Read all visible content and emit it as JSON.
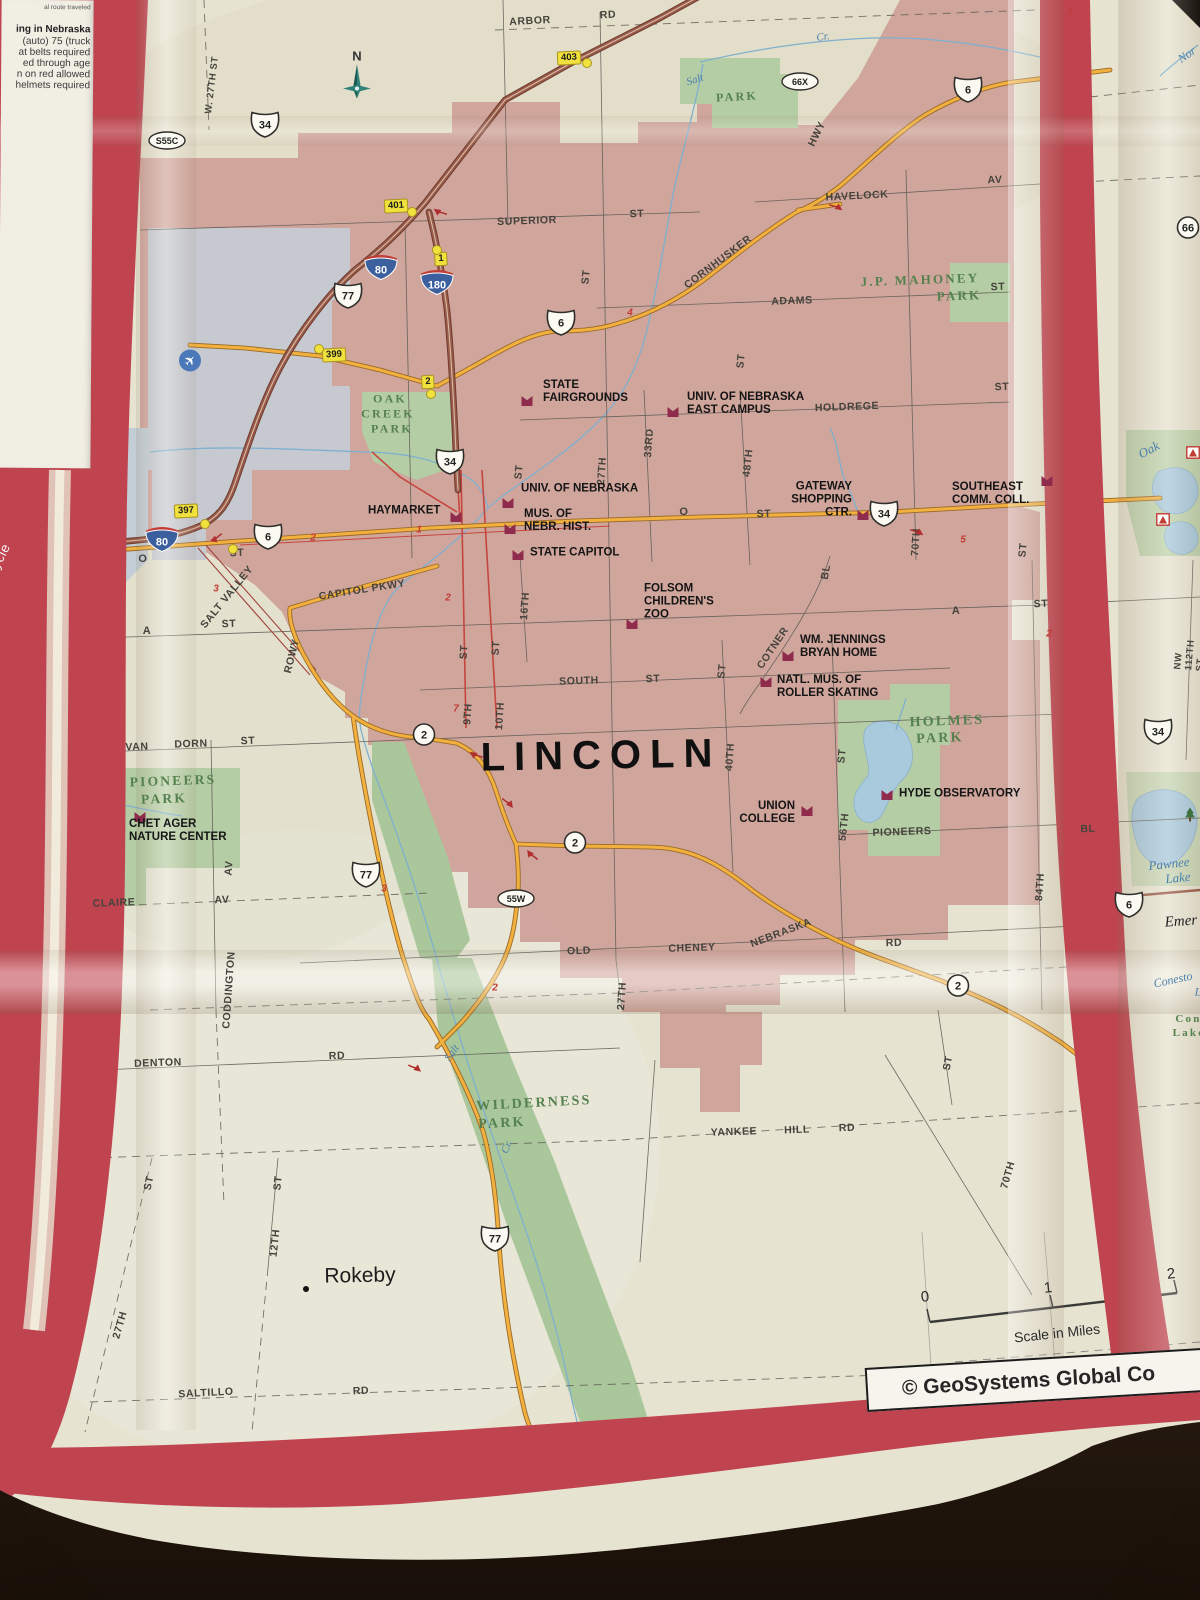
{
  "colors": {
    "border_red": "#bf4450",
    "urban_pink": "#cfa29a",
    "park_green": "#b5cda4",
    "water_blue": "#a9c9dc",
    "road_orange": "#f2b13f",
    "interstate_brown": "#9a5a48",
    "thin_red_road": "#c5463e",
    "paper": "#e7e3d1"
  },
  "panel": {
    "recycle": "♻ Please Recycle",
    "lines": [
      {
        "t": "al route traveled",
        "y": 4,
        "cls": "tiny"
      },
      {
        "t": "ing in Nebraska",
        "y": 24,
        "cls": "b"
      },
      {
        "t": "(auto) 75 (truck",
        "y": 36,
        "cls": ""
      },
      {
        "t": "at belts required",
        "y": 47,
        "cls": ""
      },
      {
        "t": "ed through age",
        "y": 58,
        "cls": ""
      },
      {
        "t": "n on red allowed",
        "y": 69,
        "cls": ""
      },
      {
        "t": "helmets required",
        "y": 80,
        "cls": ""
      }
    ]
  },
  "map": {
    "city": "LINCOLN",
    "city_xy": [
      601,
      756
    ],
    "compass": "N",
    "compass_xy": [
      357,
      82
    ],
    "credit": "© GeoSystems Global Co",
    "streets": [
      [
        "ARBOR",
        530,
        21,
        -3
      ],
      [
        "RD",
        608,
        15,
        -3
      ],
      [
        "W. 27TH ST",
        212,
        85,
        -83,
        9.5
      ],
      [
        "SUPERIOR",
        527,
        221,
        -2
      ],
      [
        "ST",
        637,
        214,
        -2
      ],
      [
        "HAVELOCK",
        857,
        196,
        -3
      ],
      [
        "AV",
        995,
        180,
        -2
      ],
      [
        "CORNHUSKER",
        718,
        262,
        -37
      ],
      [
        "HWY",
        817,
        134,
        -64
      ],
      [
        "ADAMS",
        792,
        301,
        -2
      ],
      [
        "ST",
        586,
        277,
        -84
      ],
      [
        "ST",
        998,
        287,
        -2
      ],
      [
        "HOLDREGE",
        847,
        407,
        -2
      ],
      [
        "ST",
        1002,
        387,
        -2
      ],
      [
        "ST",
        741,
        361,
        -84
      ],
      [
        "33RD",
        649,
        443,
        -86
      ],
      [
        "27TH",
        602,
        471,
        -86
      ],
      [
        "48TH",
        748,
        463,
        -84
      ],
      [
        "ST",
        519,
        472,
        -84
      ],
      [
        "70TH",
        916,
        542,
        -86
      ],
      [
        "ST",
        1023,
        550,
        -84
      ],
      [
        "O",
        684,
        512,
        0,
        11
      ],
      [
        "ST",
        764,
        514,
        -2
      ],
      [
        "O",
        143,
        559,
        0,
        11
      ],
      [
        "ST",
        237,
        553,
        -2
      ],
      [
        "SALT VALLEY",
        227,
        597,
        -51
      ],
      [
        "CAPITOL PKWY",
        362,
        590,
        -9
      ],
      [
        "16TH",
        525,
        606,
        -86
      ],
      [
        "A",
        147,
        631,
        0,
        11
      ],
      [
        "ST",
        229,
        624,
        -2
      ],
      [
        "ROWY",
        292,
        656,
        -76
      ],
      [
        "COTNER",
        773,
        648,
        -56
      ],
      [
        "BL",
        826,
        572,
        -80
      ],
      [
        "A",
        956,
        611,
        -2,
        11
      ],
      [
        "ST",
        1041,
        604,
        -2
      ],
      [
        "SOUTH",
        579,
        681,
        -2
      ],
      [
        "ST",
        653,
        679,
        -2
      ],
      [
        "ST",
        722,
        671,
        -84
      ],
      [
        "ST",
        464,
        652,
        -86
      ],
      [
        "ST",
        496,
        648,
        -86
      ],
      [
        "9TH",
        468,
        714,
        -86
      ],
      [
        "10TH",
        500,
        716,
        -86
      ],
      [
        "40TH",
        730,
        757,
        -86
      ],
      [
        "ST",
        842,
        756,
        -84
      ],
      [
        "56TH",
        844,
        827,
        -84
      ],
      [
        "PIONEERS",
        902,
        832,
        -2
      ],
      [
        "BL",
        1088,
        829,
        -2
      ],
      [
        "VAN",
        137,
        747,
        -2
      ],
      [
        "DORN",
        191,
        744,
        -2
      ],
      [
        "ST",
        248,
        741,
        -2
      ],
      [
        "AV",
        229,
        868,
        -86
      ],
      [
        "CLAIRE",
        114,
        903,
        -2
      ],
      [
        "AV",
        222,
        900,
        -2
      ],
      [
        "CODDINGTON",
        229,
        990,
        -86
      ],
      [
        "DENTON",
        158,
        1063,
        -2
      ],
      [
        "RD",
        337,
        1056,
        -2
      ],
      [
        "OLD",
        579,
        951,
        -2
      ],
      [
        "CHENEY",
        692,
        948,
        -2
      ],
      [
        "NEBRASKA",
        781,
        933,
        -21
      ],
      [
        "RD",
        894,
        943,
        -2
      ],
      [
        "84TH",
        1040,
        887,
        -86
      ],
      [
        "ST",
        948,
        1063,
        -80
      ],
      [
        "27TH",
        622,
        996,
        -86
      ],
      [
        "YANKEE",
        734,
        1132,
        -2
      ],
      [
        "HILL",
        797,
        1130,
        -2
      ],
      [
        "RD",
        847,
        1128,
        -2
      ],
      [
        "70TH",
        1008,
        1175,
        -74
      ],
      [
        "ST",
        149,
        1183,
        -78
      ],
      [
        "ST",
        278,
        1183,
        -84
      ],
      [
        "12TH",
        275,
        1243,
        -84
      ],
      [
        "27TH",
        120,
        1325,
        -74
      ],
      [
        "SALTILLO",
        206,
        1393,
        -3
      ],
      [
        "RD",
        361,
        1391,
        -3
      ],
      [
        "NW 112TH ST",
        1190,
        655,
        -85,
        9.5
      ]
    ],
    "parks": [
      [
        "J.P. MAHONEY",
        920,
        280,
        -2,
        13
      ],
      [
        "PARK",
        959,
        296,
        -2,
        13
      ],
      [
        "OAK",
        390,
        399,
        0,
        12
      ],
      [
        "CREEK",
        388,
        414,
        0,
        12
      ],
      [
        "PARK",
        392,
        429,
        0,
        12
      ],
      [
        "HOLMES",
        947,
        722,
        -2,
        14
      ],
      [
        "PARK",
        940,
        739,
        -2,
        14
      ],
      [
        "PIONEERS",
        173,
        781,
        -2,
        13.5
      ],
      [
        "PARK",
        164,
        799,
        -2,
        13.5
      ],
      [
        "WILDERNESS",
        534,
        1104,
        -3,
        14
      ],
      [
        "PARK",
        502,
        1124,
        -3,
        14
      ],
      [
        "PARK",
        737,
        97,
        -3,
        12
      ],
      [
        "Cone",
        1192,
        1019,
        0,
        11
      ],
      [
        "Lake",
        1189,
        1033,
        0,
        11
      ]
    ],
    "water": [
      [
        "Salt",
        695,
        80,
        -18,
        11
      ],
      [
        "Cr.",
        823,
        37,
        -8,
        11
      ],
      [
        "Oak",
        1149,
        450,
        -28,
        13
      ],
      [
        "Pawnee",
        1169,
        864,
        -6,
        13
      ],
      [
        "Lake",
        1178,
        878,
        -6,
        13
      ],
      [
        "Conesto",
        1173,
        980,
        -12,
        12
      ],
      [
        "L",
        1198,
        992,
        0,
        12
      ],
      [
        "Salt",
        452,
        1053,
        -55,
        11
      ],
      [
        "Cr.",
        507,
        1147,
        -66,
        11
      ],
      [
        "Nor",
        1187,
        55,
        -35,
        12
      ]
    ],
    "pois": [
      {
        "t": "STATE\nFAIRGROUNDS",
        "a": "left",
        "x": 543,
        "y": 392,
        "mx": 527,
        "my": 401
      },
      {
        "t": "UNIV. OF NEBRASKA\nEAST CAMPUS",
        "a": "left",
        "x": 687,
        "y": 404,
        "mx": 673,
        "my": 412
      },
      {
        "t": "UNIV. OF NEBRASKA",
        "a": "left",
        "x": 521,
        "y": 489,
        "mx": 508,
        "my": 503
      },
      {
        "t": "MUS. OF\nNEBR. HIST.",
        "a": "left",
        "x": 524,
        "y": 521,
        "mx": 510,
        "my": 529
      },
      {
        "t": "GATEWAY\nSHOPPING\nCTR.",
        "a": "right",
        "x": 852,
        "y": 500,
        "mx": 863,
        "my": 515
      },
      {
        "t": "SOUTHEAST\nCOMM. COLL.",
        "a": "left",
        "x": 952,
        "y": 494,
        "mx": 1047,
        "my": 481
      },
      {
        "t": "HAYMARKET",
        "a": "left",
        "x": 368,
        "y": 511,
        "mx": 456,
        "my": 517
      },
      {
        "t": "STATE CAPITOL",
        "a": "left",
        "x": 530,
        "y": 553,
        "mx": 518,
        "my": 555
      },
      {
        "t": "FOLSOM\nCHILDREN'S\nZOO",
        "a": "left",
        "x": 644,
        "y": 602,
        "mx": 632,
        "my": 624
      },
      {
        "t": "WM. JENNINGS\nBRYAN HOME",
        "a": "left",
        "x": 800,
        "y": 647,
        "mx": 788,
        "my": 656
      },
      {
        "t": "NATL. MUS. OF\nROLLER SKATING",
        "a": "left",
        "x": 777,
        "y": 687,
        "mx": 766,
        "my": 682
      },
      {
        "t": "UNION\nCOLLEGE",
        "a": "right",
        "x": 795,
        "y": 813,
        "mx": 807,
        "my": 811
      },
      {
        "t": "HYDE OBSERVATORY",
        "a": "left",
        "x": 899,
        "y": 794,
        "mx": 887,
        "my": 795
      },
      {
        "t": "CHET AGER\nNATURE CENTER",
        "a": "left",
        "x": 129,
        "y": 831,
        "mx": 140,
        "my": 817
      }
    ],
    "towns": [
      {
        "t": "Rokeby",
        "x": 360,
        "y": 1276,
        "dot": [
          306,
          1289
        ]
      }
    ],
    "emerald": {
      "t": "Emer",
      "x": 1181,
      "y": 922
    },
    "shields": {
      "interstate": [
        [
          "80",
          381,
          268
        ],
        [
          "180",
          437,
          283
        ],
        [
          "80",
          162,
          540
        ]
      ],
      "us": [
        [
          "77",
          348,
          297
        ],
        [
          "6",
          561,
          324
        ],
        [
          "6",
          968,
          91
        ],
        [
          "34",
          450,
          463
        ],
        [
          "34",
          884,
          515
        ],
        [
          "6",
          268,
          538
        ],
        [
          "77",
          366,
          876
        ],
        [
          "77",
          495,
          1240
        ],
        [
          "34",
          1158,
          733
        ],
        [
          "6",
          1129,
          906
        ],
        [
          "34",
          265,
          126
        ]
      ],
      "state": [
        [
          "2",
          424,
          737
        ],
        [
          "2",
          575,
          845
        ],
        [
          "2",
          958,
          988
        ],
        [
          "66",
          1188,
          230
        ]
      ],
      "oval": [
        [
          "S55C",
          167,
          143
        ],
        [
          "66X",
          800,
          84
        ],
        [
          "55W",
          516,
          901
        ]
      ]
    },
    "exits": [
      [
        "403",
        569,
        58
      ],
      [
        "401",
        396,
        206
      ],
      [
        "1",
        441,
        259
      ],
      [
        "399",
        334,
        355
      ],
      [
        "2",
        428,
        382
      ],
      [
        "397",
        186,
        511
      ]
    ],
    "gores": [
      [
        587,
        63
      ],
      [
        412,
        212
      ],
      [
        437,
        250
      ],
      [
        319,
        349
      ],
      [
        431,
        394
      ],
      [
        205,
        524
      ],
      [
        233,
        549
      ]
    ],
    "rednums": [
      [
        "2",
        313,
        538
      ],
      [
        "1",
        419,
        530
      ],
      [
        "3",
        216,
        589
      ],
      [
        "5",
        963,
        540
      ],
      [
        "4",
        630,
        313
      ],
      [
        "7",
        456,
        709
      ],
      [
        "3",
        384,
        889
      ],
      [
        "2",
        448,
        598
      ],
      [
        "2",
        495,
        988
      ],
      [
        "7",
        1070,
        13
      ],
      [
        "2",
        1049,
        634
      ]
    ],
    "arrows": [
      [
        836,
        207,
        35
      ],
      [
        216,
        538,
        160
      ],
      [
        476,
        755,
        215
      ],
      [
        508,
        803,
        55
      ],
      [
        532,
        855,
        235
      ],
      [
        415,
        1068,
        40
      ],
      [
        440,
        212,
        215
      ],
      [
        917,
        532,
        35
      ]
    ],
    "camps": [
      [
        1193,
        455
      ],
      [
        1163,
        522
      ]
    ],
    "tree": [
      1190,
      817
    ],
    "plane": [
      190,
      363
    ],
    "scale": {
      "ticks": [
        [
          "0",
          925,
          1297
        ],
        [
          "1",
          1048,
          1288
        ],
        [
          "2",
          1171,
          1274
        ]
      ],
      "label": "Scale in Miles",
      "lx": 1057,
      "ly": 1333
    }
  }
}
